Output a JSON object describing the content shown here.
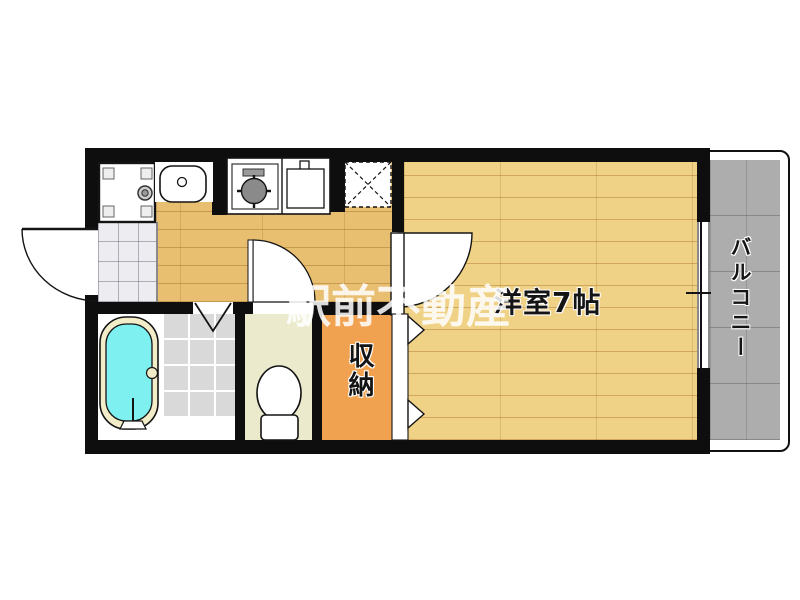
{
  "plan": {
    "type": "japanese-apartment-floor-plan",
    "labels": {
      "main_room": "洋室7帖",
      "storage": "収納",
      "balcony": "バルコニー"
    },
    "watermark": "駅前不動産",
    "colors": {
      "wall": "#0e0e0e",
      "hall_wood_floor": "#e8be70",
      "room_wood_floor": "#f0d286",
      "storage_fill": "#f1a251",
      "toilet_floor": "#eceacc",
      "bath_tile": "#d9d9d9",
      "entrance_tile": "#ededf1",
      "balcony_concrete": "#adadad",
      "bathtub_water": "#7ff0f0",
      "bathtub_rim": "#f2ecc8",
      "watermark_text": "#ffffff"
    },
    "fixtures": [
      "washing-machine-pan",
      "wash-basin",
      "gas-stove-single-burner",
      "kitchen-sink",
      "refrigerator-space",
      "bathtub",
      "toilet",
      "entry-door-swing",
      "room-door-swing",
      "toilet-door-swing",
      "bathroom-folding-door",
      "closet-folding-door",
      "balcony-window",
      "balcony-railing"
    ]
  }
}
